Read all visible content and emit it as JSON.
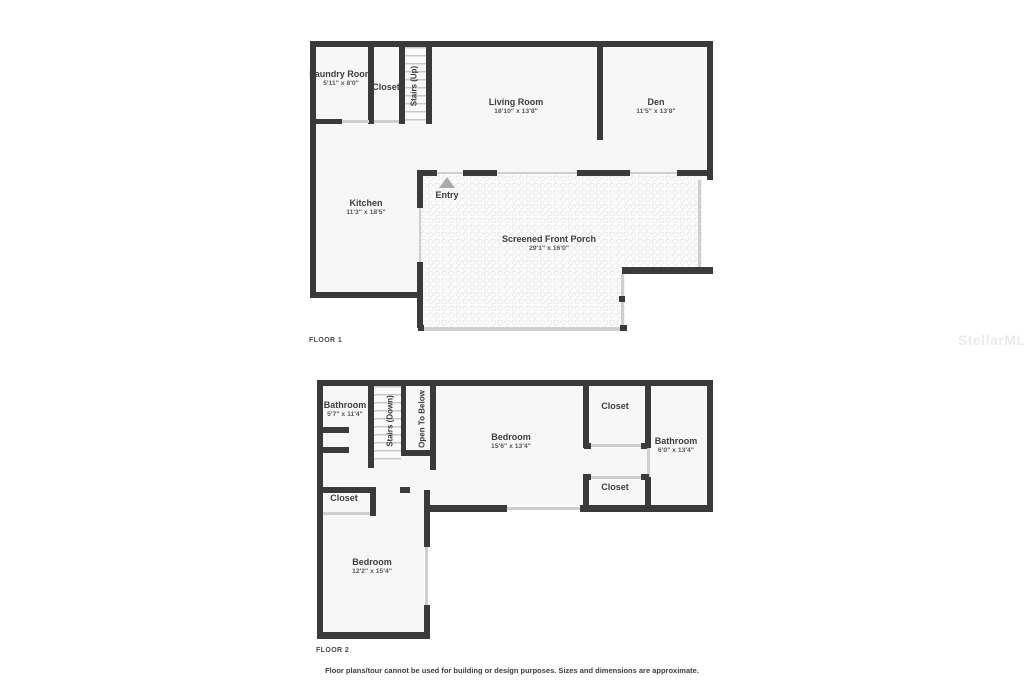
{
  "watermark": "StellarMLS",
  "floor1": {
    "label": "FLOOR 1",
    "rooms": {
      "laundry": {
        "name": "Laundry Room",
        "dims": "5'11\" x 8'0\""
      },
      "closet": {
        "name": "Closet"
      },
      "stairs": {
        "name": "Stairs (Up)"
      },
      "living": {
        "name": "Living Room",
        "dims": "18'10\" x 13'8\""
      },
      "den": {
        "name": "Den",
        "dims": "11'5\" x 13'8\""
      },
      "kitchen": {
        "name": "Kitchen",
        "dims": "11'3\" x 18'5\""
      },
      "entry": {
        "name": "Entry"
      },
      "porch": {
        "name": "Screened Front Porch",
        "dims": "29'1\" x 16'0\""
      }
    }
  },
  "floor2": {
    "label": "FLOOR 2",
    "rooms": {
      "bathroom_left": {
        "name": "Bathroom",
        "dims": "5'7\" x 11'4\""
      },
      "stairs": {
        "name": "Stairs (Down)"
      },
      "open_below": {
        "name": "Open To Below"
      },
      "bedroom_main": {
        "name": "Bedroom",
        "dims": "15'6\" x 13'4\""
      },
      "closet_top": {
        "name": "Closet"
      },
      "bathroom_right": {
        "name": "Bathroom",
        "dims": "6'0\" x 13'4\""
      },
      "closet_bottom": {
        "name": "Closet"
      },
      "closet_left": {
        "name": "Closet"
      },
      "bedroom_lower": {
        "name": "Bedroom",
        "dims": "12'2\" x 15'4\""
      }
    }
  },
  "footer": {
    "disclaimer": "Floor plans/tour cannot be used for building or design purposes. Sizes and dimensions are approximate."
  }
}
